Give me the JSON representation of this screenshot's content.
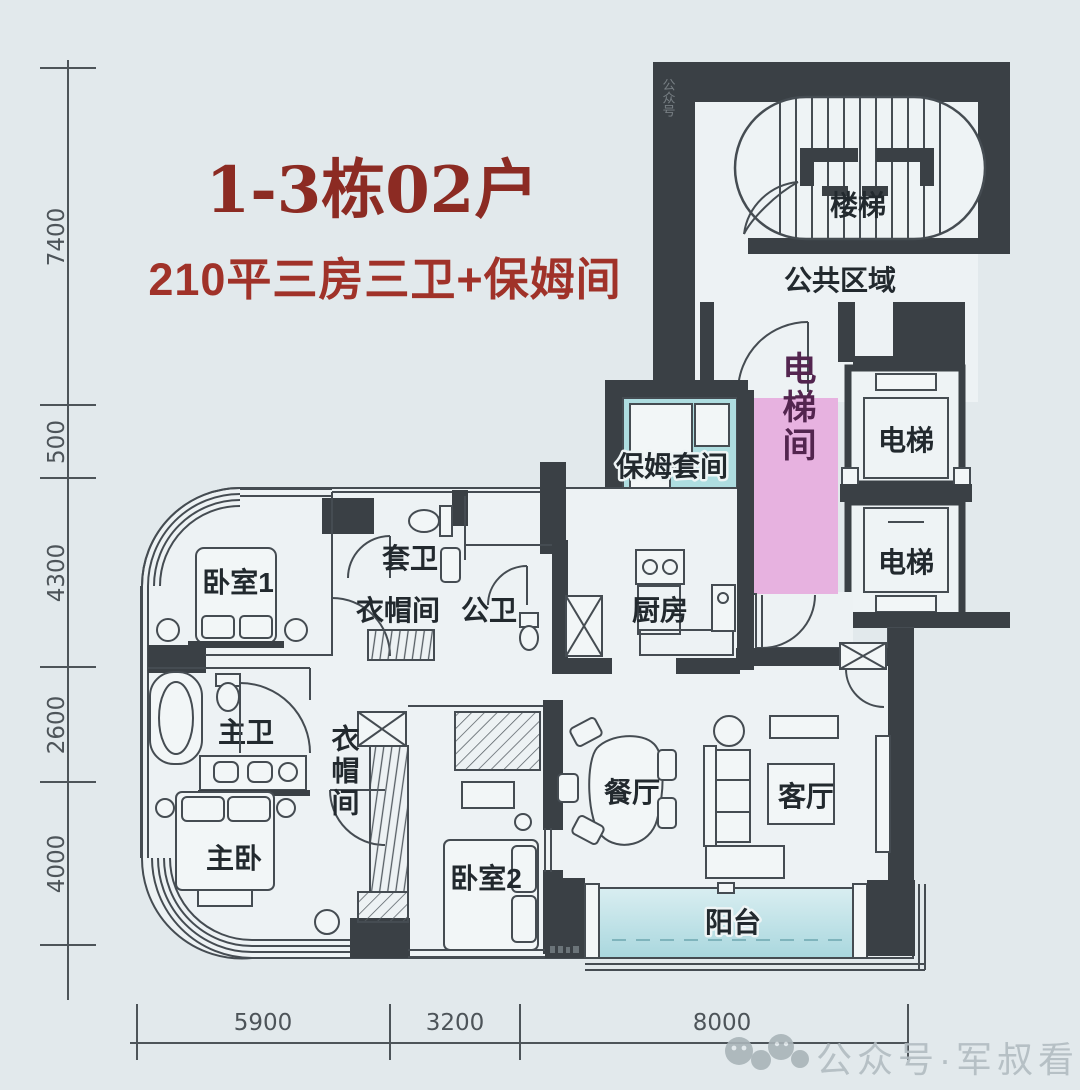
{
  "title": "1-3栋02户",
  "subtitle": "210平三房三卫+保姆间",
  "rooms": {
    "stairs": "楼梯",
    "public_area": "公共区域",
    "elevator_a": "电梯",
    "elevator_b": "电梯",
    "elevator_hall": "电梯间",
    "nanny_suite": "保姆套间",
    "service_balcony": "生活阳台",
    "kitchen": "厨房",
    "bedroom1": "卧室1",
    "ensuite_bath": "套卫",
    "cloakroom_upper": "衣帽间",
    "guest_bath": "公卫",
    "master_bath": "主卫",
    "master_bedroom": "主卧",
    "cloakroom_center": "衣帽间",
    "bedroom2": "卧室2",
    "dining_room": "餐厅",
    "living_room": "客厅",
    "balcony": "阳台"
  },
  "dimensions": {
    "left": [
      "7400",
      "500",
      "4300",
      "2600",
      "4000"
    ],
    "bottom": [
      "5900",
      "3200",
      "8000"
    ]
  },
  "watermark": {
    "text": "公众号·军叔看楼市",
    "side_text": "公众号"
  },
  "colors": {
    "background": "#e2e9ec",
    "wall": "#3a4045",
    "line": "#454c52",
    "title_red": "#8c2b23",
    "subtitle_red": "#a03229",
    "elevator_hall_pink": "#e7b2e0",
    "teal_highlight": "#aedde0",
    "balcony_teal_light": "#d9eef1",
    "balcony_teal_dark": "#a9d7de",
    "watermark_gray": "#b2bcc1"
  }
}
